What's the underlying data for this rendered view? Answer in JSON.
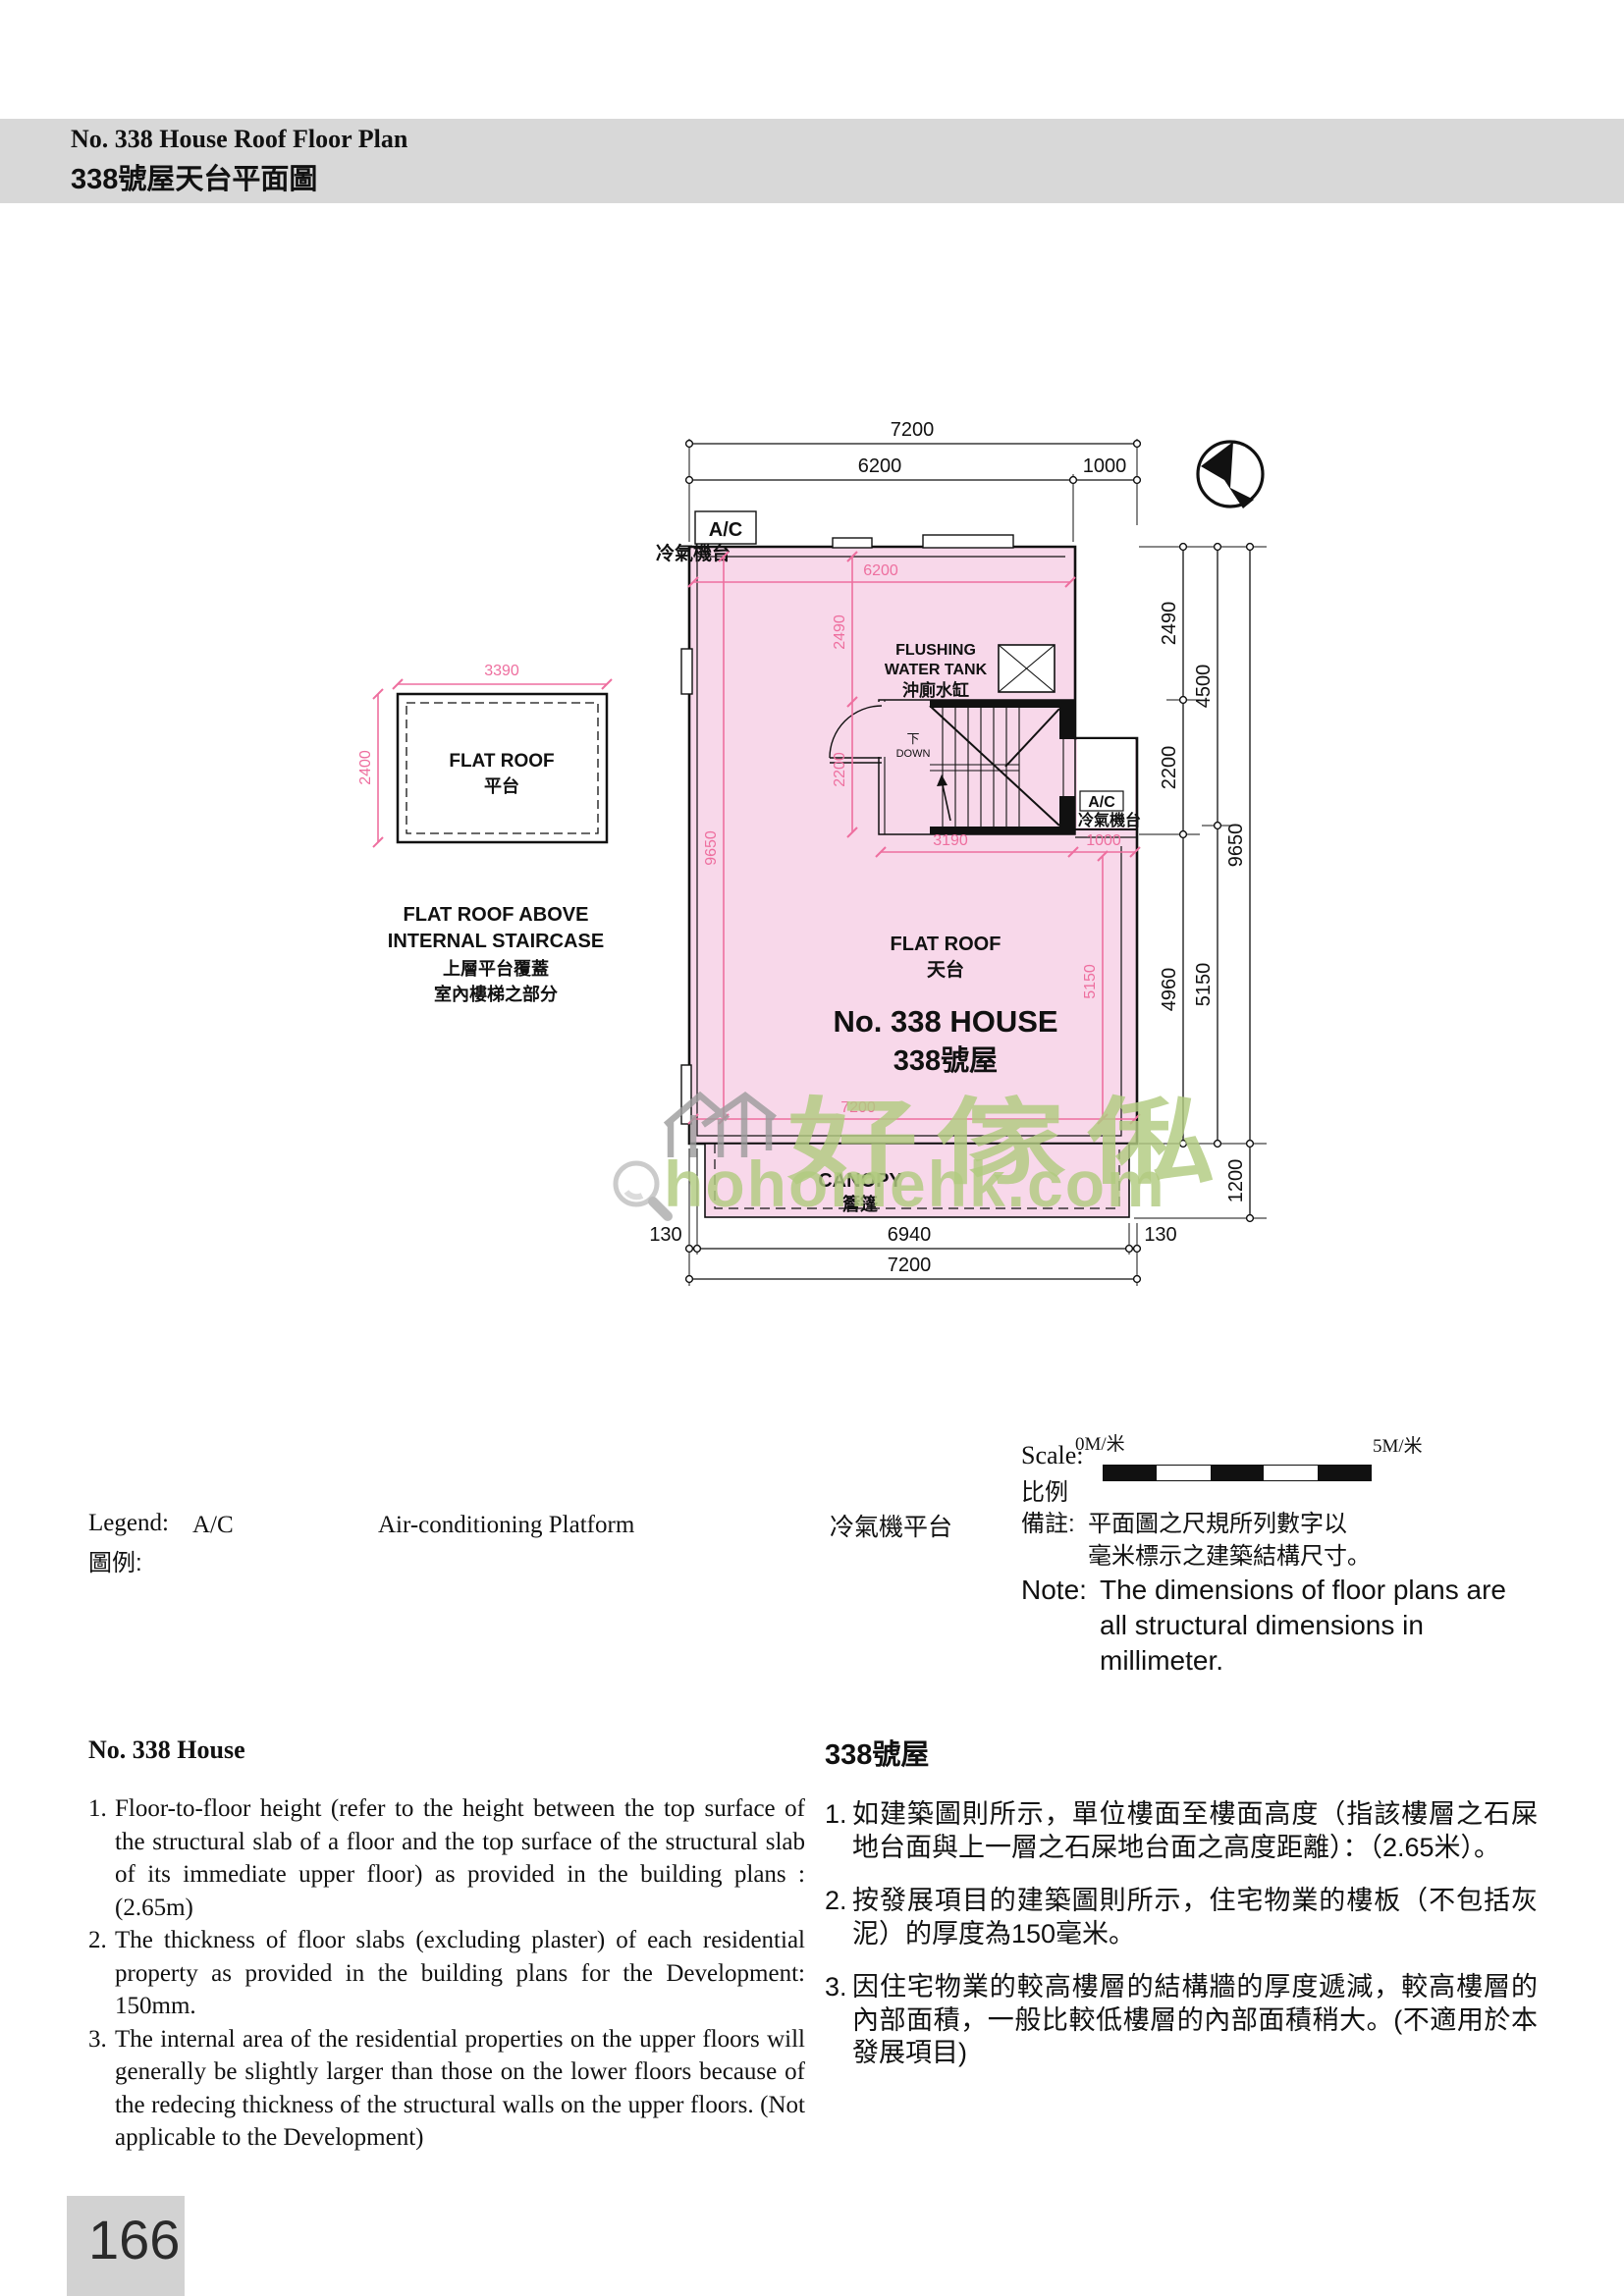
{
  "header": {
    "title_en": "No. 338 House Roof Floor Plan",
    "title_zh": "338號屋天台平面圖"
  },
  "colors": {
    "roof_fill": "#f8d8ea",
    "pink_dim": "#ee6f9f",
    "watermark_green": "#b1ca80",
    "header_gray": "#d8d8d8"
  },
  "plan": {
    "labels": {
      "ac": "A/C",
      "ac_zh": "冷氣機台",
      "flushing_1": "FLUSHING",
      "flushing_2": "WATER TANK",
      "flushing_zh": "沖廁水缸",
      "down_zh": "下",
      "down_en": "DOWN",
      "flat_roof_en": "FLAT ROOF",
      "flat_roof_zh": "天台",
      "house_en": "No. 338 HOUSE",
      "house_zh": "338號屋",
      "canopy_en": "CANOPY",
      "canopy_zh": "簷篷",
      "side_flat_roof_en": "FLAT ROOF",
      "side_flat_roof_zh": "平台",
      "side_caption_1": "FLAT ROOF ABOVE",
      "side_caption_2": "INTERNAL STAIRCASE",
      "side_caption_3": "上層平台覆蓋",
      "side_caption_4": "室內樓梯之部分"
    },
    "dims": {
      "black": {
        "top_total": "7200",
        "top_main": "6200",
        "top_ext": "1000",
        "r_2490": "2490",
        "r_2200": "2200",
        "r_4960": "4960",
        "r_4500": "4500",
        "r_5150": "5150",
        "r_9650": "9650",
        "r_1200": "1200",
        "b_130l": "130",
        "b_6940": "6940",
        "b_130r": "130",
        "b_total": "7200"
      },
      "pink": {
        "h6200": "6200",
        "v2490": "2490",
        "v2200": "2200",
        "v9650": "9650",
        "h3190": "3190",
        "h1000": "1000",
        "v5150": "5150",
        "h7200": "7200",
        "side_w": "3390",
        "side_h": "2400"
      }
    }
  },
  "scale": {
    "label_en": "Scale:",
    "label_zh": "比例",
    "start": "0M/米",
    "end": "5M/米"
  },
  "legend": {
    "label_en": "Legend:",
    "label_zh": "圖例:",
    "key": "A/C",
    "value_en": "Air-conditioning Platform",
    "value_zh": "冷氣機平台"
  },
  "note": {
    "label_zh": "備註:",
    "zh_line1": "平面圖之尺規所列數字以",
    "zh_line2": "毫米標示之建築結構尺寸。",
    "label_en": "Note:",
    "en_line1": "The dimensions of floor plans are",
    "en_line2": "all structural dimensions in",
    "en_line3": "millimeter."
  },
  "notes_en": {
    "heading": "No. 338 House",
    "items": [
      {
        "num": "1.",
        "text": "Floor-to-floor height (refer to the height between the top surface of the structural slab of a floor and the top surface of the structural slab of its immediate upper floor) as provided in the building plans : (2.65m)"
      },
      {
        "num": "2.",
        "text": "The thickness of floor slabs (excluding plaster) of each residential property as provided in the building plans for the Development: 150mm."
      },
      {
        "num": "3.",
        "text": "The internal area of the residential properties on the upper floors will generally be slightly larger than those on the lower floors because of the redecing thickness of the structural walls on the upper floors. (Not applicable to the Development)"
      }
    ]
  },
  "notes_zh": {
    "heading": "338號屋",
    "items": [
      {
        "num": "1.",
        "text": "如建築圖則所示，單位樓面至樓面高度（指該樓層之石屎地台面與上一層之石屎地台面之高度距離）：（2.65米）。"
      },
      {
        "num": "2.",
        "text": "按發展項目的建築圖則所示，住宅物業的樓板（不包括灰泥）的厚度為150毫米。"
      },
      {
        "num": "3.",
        "text": "因住宅物業的較高樓層的結構牆的厚度遞減，較高樓層的內部面積，一般比較低樓層的內部面積稍大。(不適用於本發展項目)"
      }
    ]
  },
  "watermark": {
    "brand": "好傢俬",
    "domain": "hohomehk.com"
  },
  "page_number": "166"
}
